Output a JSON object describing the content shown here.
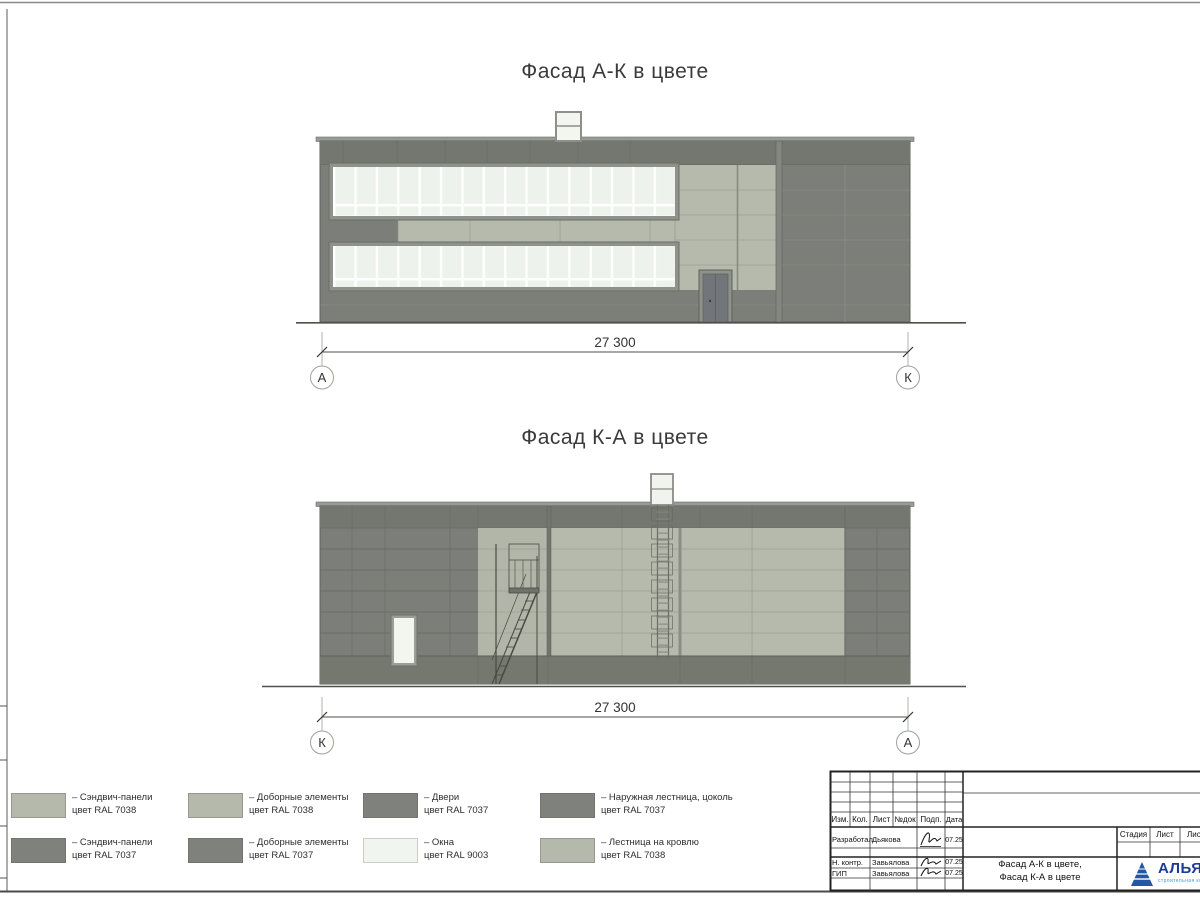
{
  "sheet": {
    "facade1_title": "Фасад А-К в цвете",
    "facade2_title": "Фасад К-А в цвете",
    "dimensions": {
      "facade1": "27 300",
      "facade2": "27 300"
    },
    "axis_markers": {
      "facade1_left": "А",
      "facade1_right": "К",
      "facade2_left": "К",
      "facade2_right": "А"
    }
  },
  "legend": {
    "items": [
      {
        "swatch": "#b5b9ac",
        "line1": "– Сэндвич-панели",
        "line2": "цвет RAL 7038"
      },
      {
        "swatch": "#b5b9ac",
        "line1": "– Доборные элементы",
        "line2": "цвет RAL 7038"
      },
      {
        "swatch": "#7f827c",
        "line1": "– Двери",
        "line2": "цвет RAL 7037"
      },
      {
        "swatch": "#7f827c",
        "line1": "– Наружная лестница, цоколь",
        "line2": "цвет RAL 7037"
      },
      {
        "swatch": "#7f827c",
        "line1": "– Сэндвич-панели",
        "line2": "цвет RAL 7037"
      },
      {
        "swatch": "#7f827c",
        "line1": "– Доборные элементы",
        "line2": "цвет RAL 7037"
      },
      {
        "swatch": "#f1f5ef",
        "line1": "– Окна",
        "line2": "цвет RAL 9003"
      },
      {
        "swatch": "#b5b9ac",
        "line1": "– Лестница на кровлю",
        "line2": "цвет RAL 7038"
      }
    ]
  },
  "title_block": {
    "columns": [
      "Изм.",
      "Кол.",
      "Лист",
      "№док",
      "Подп.",
      "Дата"
    ],
    "rows": [
      {
        "role": "Разработал",
        "name": "Дьякова",
        "date": "07.25"
      },
      {
        "role": "Н. контр.",
        "name": "Завьялова",
        "date": "07.25"
      },
      {
        "role": "ГИП",
        "name": "Завьялова",
        "date": "07.25"
      }
    ],
    "stage_table": {
      "stage_label": "Стадия",
      "sheet_label": "Лист",
      "sheets_label": "Листов"
    },
    "drawing_title_line1": "Фасад А-К в цвете,",
    "drawing_title_line2": "Фасад К-А в цвете",
    "company": {
      "name": "АЛЬЯНС",
      "subtitle": "строительная компания"
    }
  },
  "colors": {
    "panel_light_ral7038": "#b5b9ac",
    "panel_dark_ral7037": "#7c7f79",
    "window_ral9003": "#edf2ec",
    "plinth": "#74776f",
    "logo_blue": "#2257a5",
    "logo_text_blue": "#1c3b96"
  }
}
